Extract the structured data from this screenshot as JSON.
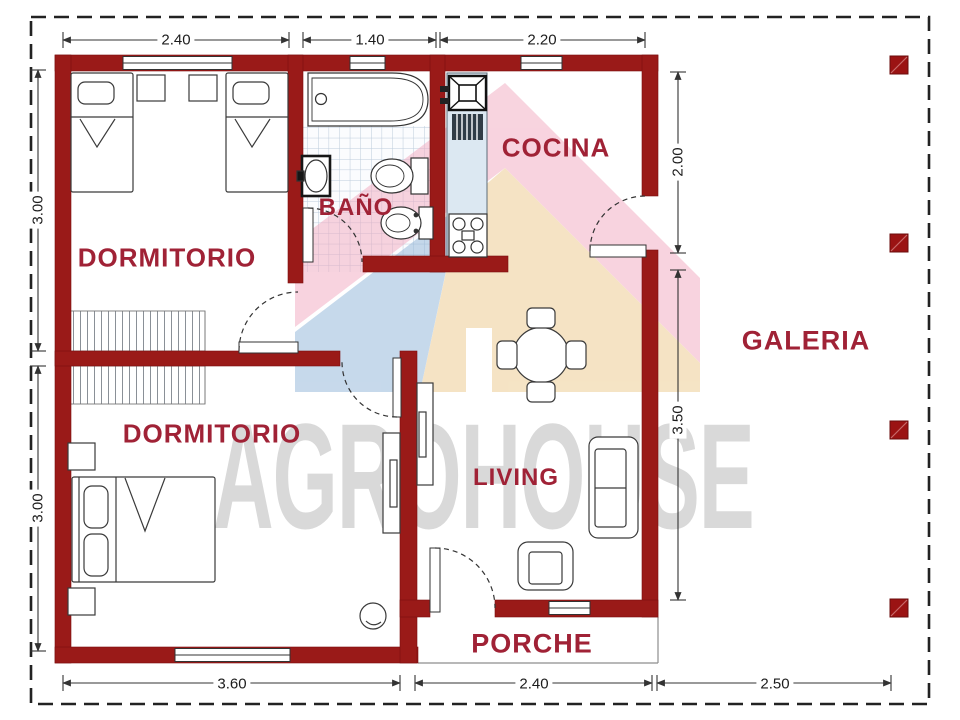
{
  "watermark": {
    "brand": "AGROHOUSE"
  },
  "rooms": {
    "dormitorio1": "DORMITORIO",
    "bano": "BAÑO",
    "cocina": "COCINA",
    "dormitorio2": "DORMITORIO",
    "living": "LIVING",
    "porche": "PORCHE",
    "galeria": "GALERIA"
  },
  "dimensions": {
    "top": [
      "2.40",
      "1.40",
      "2.20"
    ],
    "left": [
      "3.00",
      "3.00"
    ],
    "right": [
      "2.00",
      "3.50"
    ],
    "bottom": [
      "3.60",
      "2.40",
      "2.50"
    ]
  },
  "colors": {
    "wall": "#9a1a18",
    "room_label": "#a02236",
    "dimension_text": "#1c1c1c",
    "watermark_pink": "#f2a9c0",
    "watermark_blue": "#8fb4d8",
    "watermark_beige": "#ecc98b",
    "watermark_text": "#d6d6d6",
    "kitchen_counter": "#dce8f2"
  }
}
